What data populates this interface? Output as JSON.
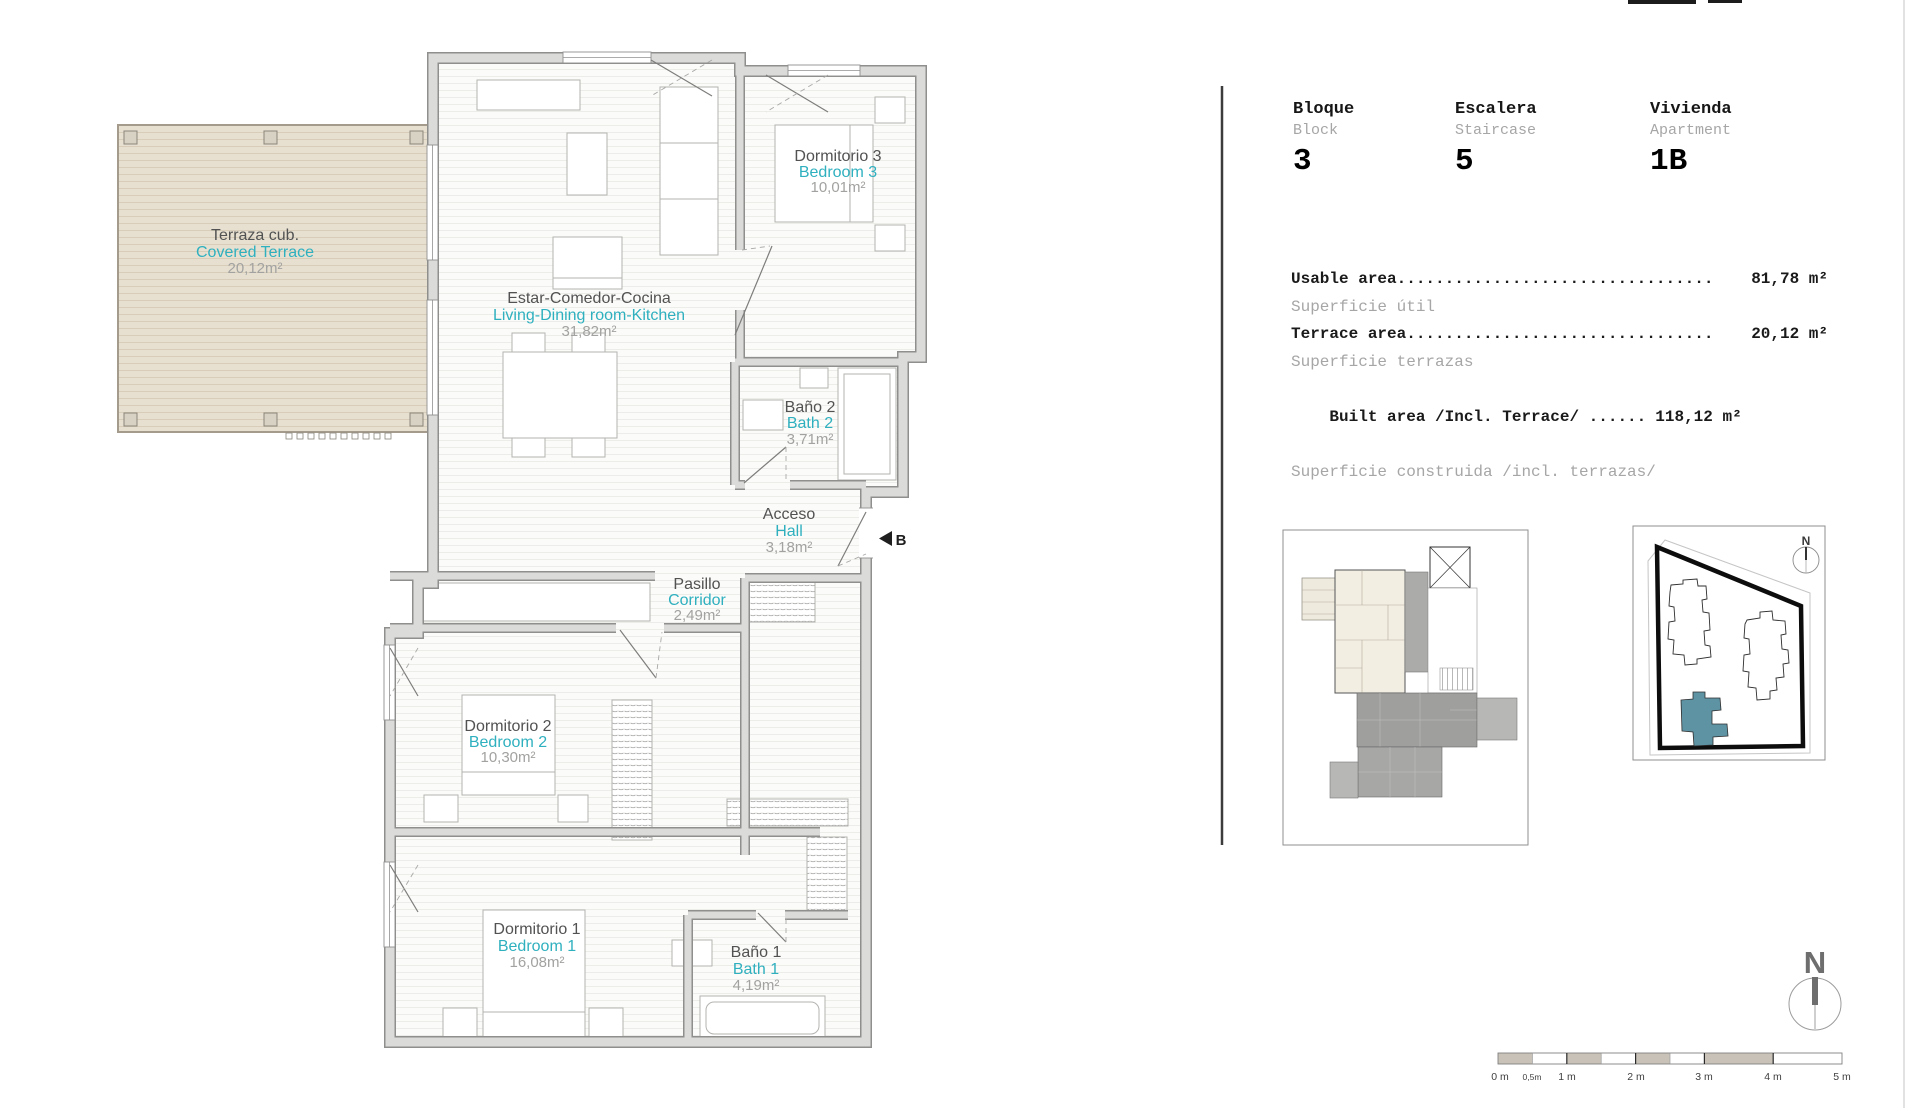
{
  "plan": {
    "rooms": [
      {
        "id": "terrace",
        "es": "Terraza cub.",
        "en": "Covered Terrace",
        "area": "20,12m²"
      },
      {
        "id": "living",
        "es": "Estar-Comedor-Cocina",
        "en": "Living-Dining room-Kitchen",
        "area": "31,82m²"
      },
      {
        "id": "bedroom3",
        "es": "Dormitorio 3",
        "en": "Bedroom 3",
        "area": "10,01m²"
      },
      {
        "id": "bath2",
        "es": "Baño 2",
        "en": "Bath 2",
        "area": "3,71m²"
      },
      {
        "id": "hall",
        "es": "Acceso",
        "en": "Hall",
        "area": "3,18m²"
      },
      {
        "id": "corridor",
        "es": "Pasillo",
        "en": "Corridor",
        "area": "2,49m²"
      },
      {
        "id": "bedroom2",
        "es": "Dormitorio 2",
        "en": "Bedroom 2",
        "area": "10,30m²"
      },
      {
        "id": "bedroom1",
        "es": "Dormitorio 1",
        "en": "Bedroom 1",
        "area": "16,08m²"
      },
      {
        "id": "bath1",
        "es": "Baño 1",
        "en": "Bath 1",
        "area": "4,19m²"
      }
    ],
    "entrance_label": "B"
  },
  "info": {
    "block": {
      "es": "Bloque",
      "en": "Block",
      "value": "3"
    },
    "staircase": {
      "es": "Escalera",
      "en": "Staircase",
      "value": "5"
    },
    "apartment": {
      "es": "Vivienda",
      "en": "Apartment",
      "value": "1B"
    },
    "areas": [
      {
        "label": "Usable area.................................",
        "es": "Superficie útil",
        "value": "81,78 m²"
      },
      {
        "label": "Terrace area................................",
        "es": "Superficie terrazas",
        "value": "20,12 m²"
      },
      {
        "label": "Built area /Incl. Terrace/ ......",
        "es": "Superficie construida /incl. terrazas/",
        "value": "118,12 m²"
      }
    ]
  },
  "compass": {
    "label": "N"
  },
  "site": {
    "north_label": "N"
  },
  "scalebar": {
    "labels": [
      "0 m",
      "0,5m",
      "1 m",
      "2 m",
      "3 m",
      "4 m",
      "5 m"
    ]
  },
  "colors": {
    "accent_teal": "#2fb0bf",
    "wall_gray": "#dbdbd9",
    "terrace_deck": "#e7e0d1",
    "site_building": "#5e93a4"
  }
}
